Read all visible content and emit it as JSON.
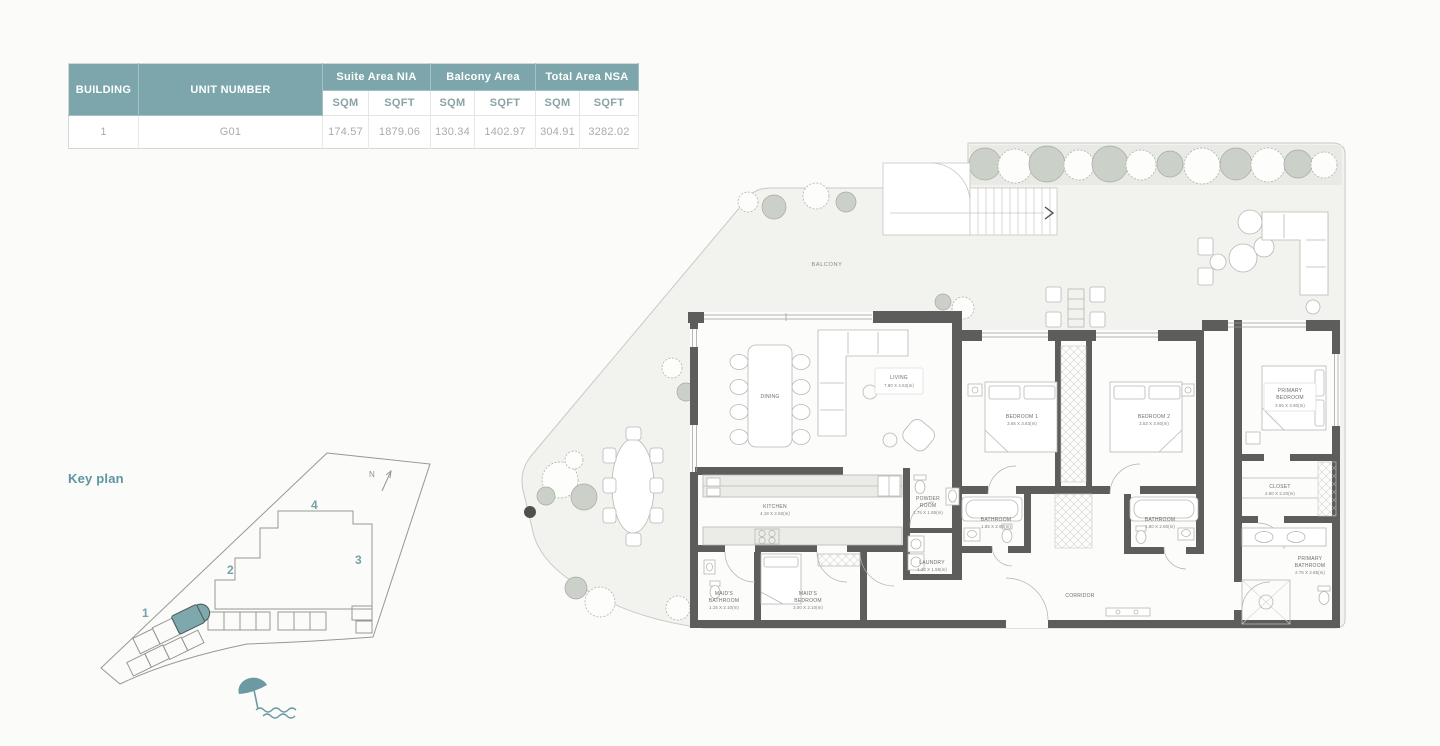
{
  "colors": {
    "accent_teal": "#7CA6AB",
    "keyplan_text": "#5D96A0",
    "table_value_text": "#A8ADAB",
    "wall": "#5D5D5B",
    "site_fill": "#F2F2EF",
    "highlight_unit": "#7FA8AD"
  },
  "area_table": {
    "header": {
      "building": "BUILDING",
      "unit_number": "UNIT NUMBER",
      "groups": [
        "Suite Area NIA",
        "Balcony Area",
        "Total Area NSA"
      ],
      "sqm": "SQM",
      "sqft": "SQFT"
    },
    "row": {
      "building": "1",
      "unit": "G01",
      "suite_sqm": "174.57",
      "suite_sqft": "1879.06",
      "balcony_sqm": "130.34",
      "balcony_sqft": "1402.97",
      "total_sqm": "304.91",
      "total_sqft": "3282.02"
    }
  },
  "key_plan": {
    "title": "Key plan",
    "north": "N",
    "buildings": {
      "b1": "1",
      "b2": "2",
      "b3": "3",
      "b4": "4"
    }
  },
  "floor_plan": {
    "rooms": {
      "balcony": {
        "name": "BALCONY"
      },
      "dining": {
        "name": "DINING"
      },
      "living": {
        "name": "LIVING",
        "dims": "7.80 X 4.53(m)"
      },
      "kitchen": {
        "name": "KITCHEN",
        "dims": "4.18 X 2.92(m)"
      },
      "maids_bathroom": {
        "name1": "MAID'S",
        "name2": "BATHROOM",
        "dims": "1.15 X 2.10(m)"
      },
      "maids_bedroom": {
        "name1": "MAID'S",
        "name2": "BEDROOM",
        "dims": "3.00 X 2.10(m)"
      },
      "powder_room": {
        "name1": "POWDER",
        "name2": "ROOM",
        "dims": "1.75 X 1.85(m)"
      },
      "laundry": {
        "name": "LAUNDRY",
        "dims": "1.20 X 1.55(m)"
      },
      "bathroom_1": {
        "name": "BATHROOM",
        "dims": "1.85 X 2.90(m)"
      },
      "bedroom_1": {
        "name": "BEDROOM 1",
        "dims": "3.65 X 3.83(m)"
      },
      "bedroom_2": {
        "name": "BEDROOM 2",
        "dims": "3.53 X 3.60(m)"
      },
      "bathroom_2": {
        "name": "BATHROOM",
        "dims": "1.80 X 2.60(m)"
      },
      "closet": {
        "name": "CLOSET",
        "dims": "2.80 X 2.20(m)"
      },
      "primary_bedroom": {
        "name1": "PRIMARY",
        "name2": "BEDROOM",
        "dims": "3.55 X 3.90(m)"
      },
      "primary_bathroom": {
        "name1": "PRIMARY",
        "name2": "BATHROOM",
        "dims": "2.75 X 2.85(m)"
      },
      "corridor": {
        "name": "CORRIDOR"
      }
    }
  }
}
